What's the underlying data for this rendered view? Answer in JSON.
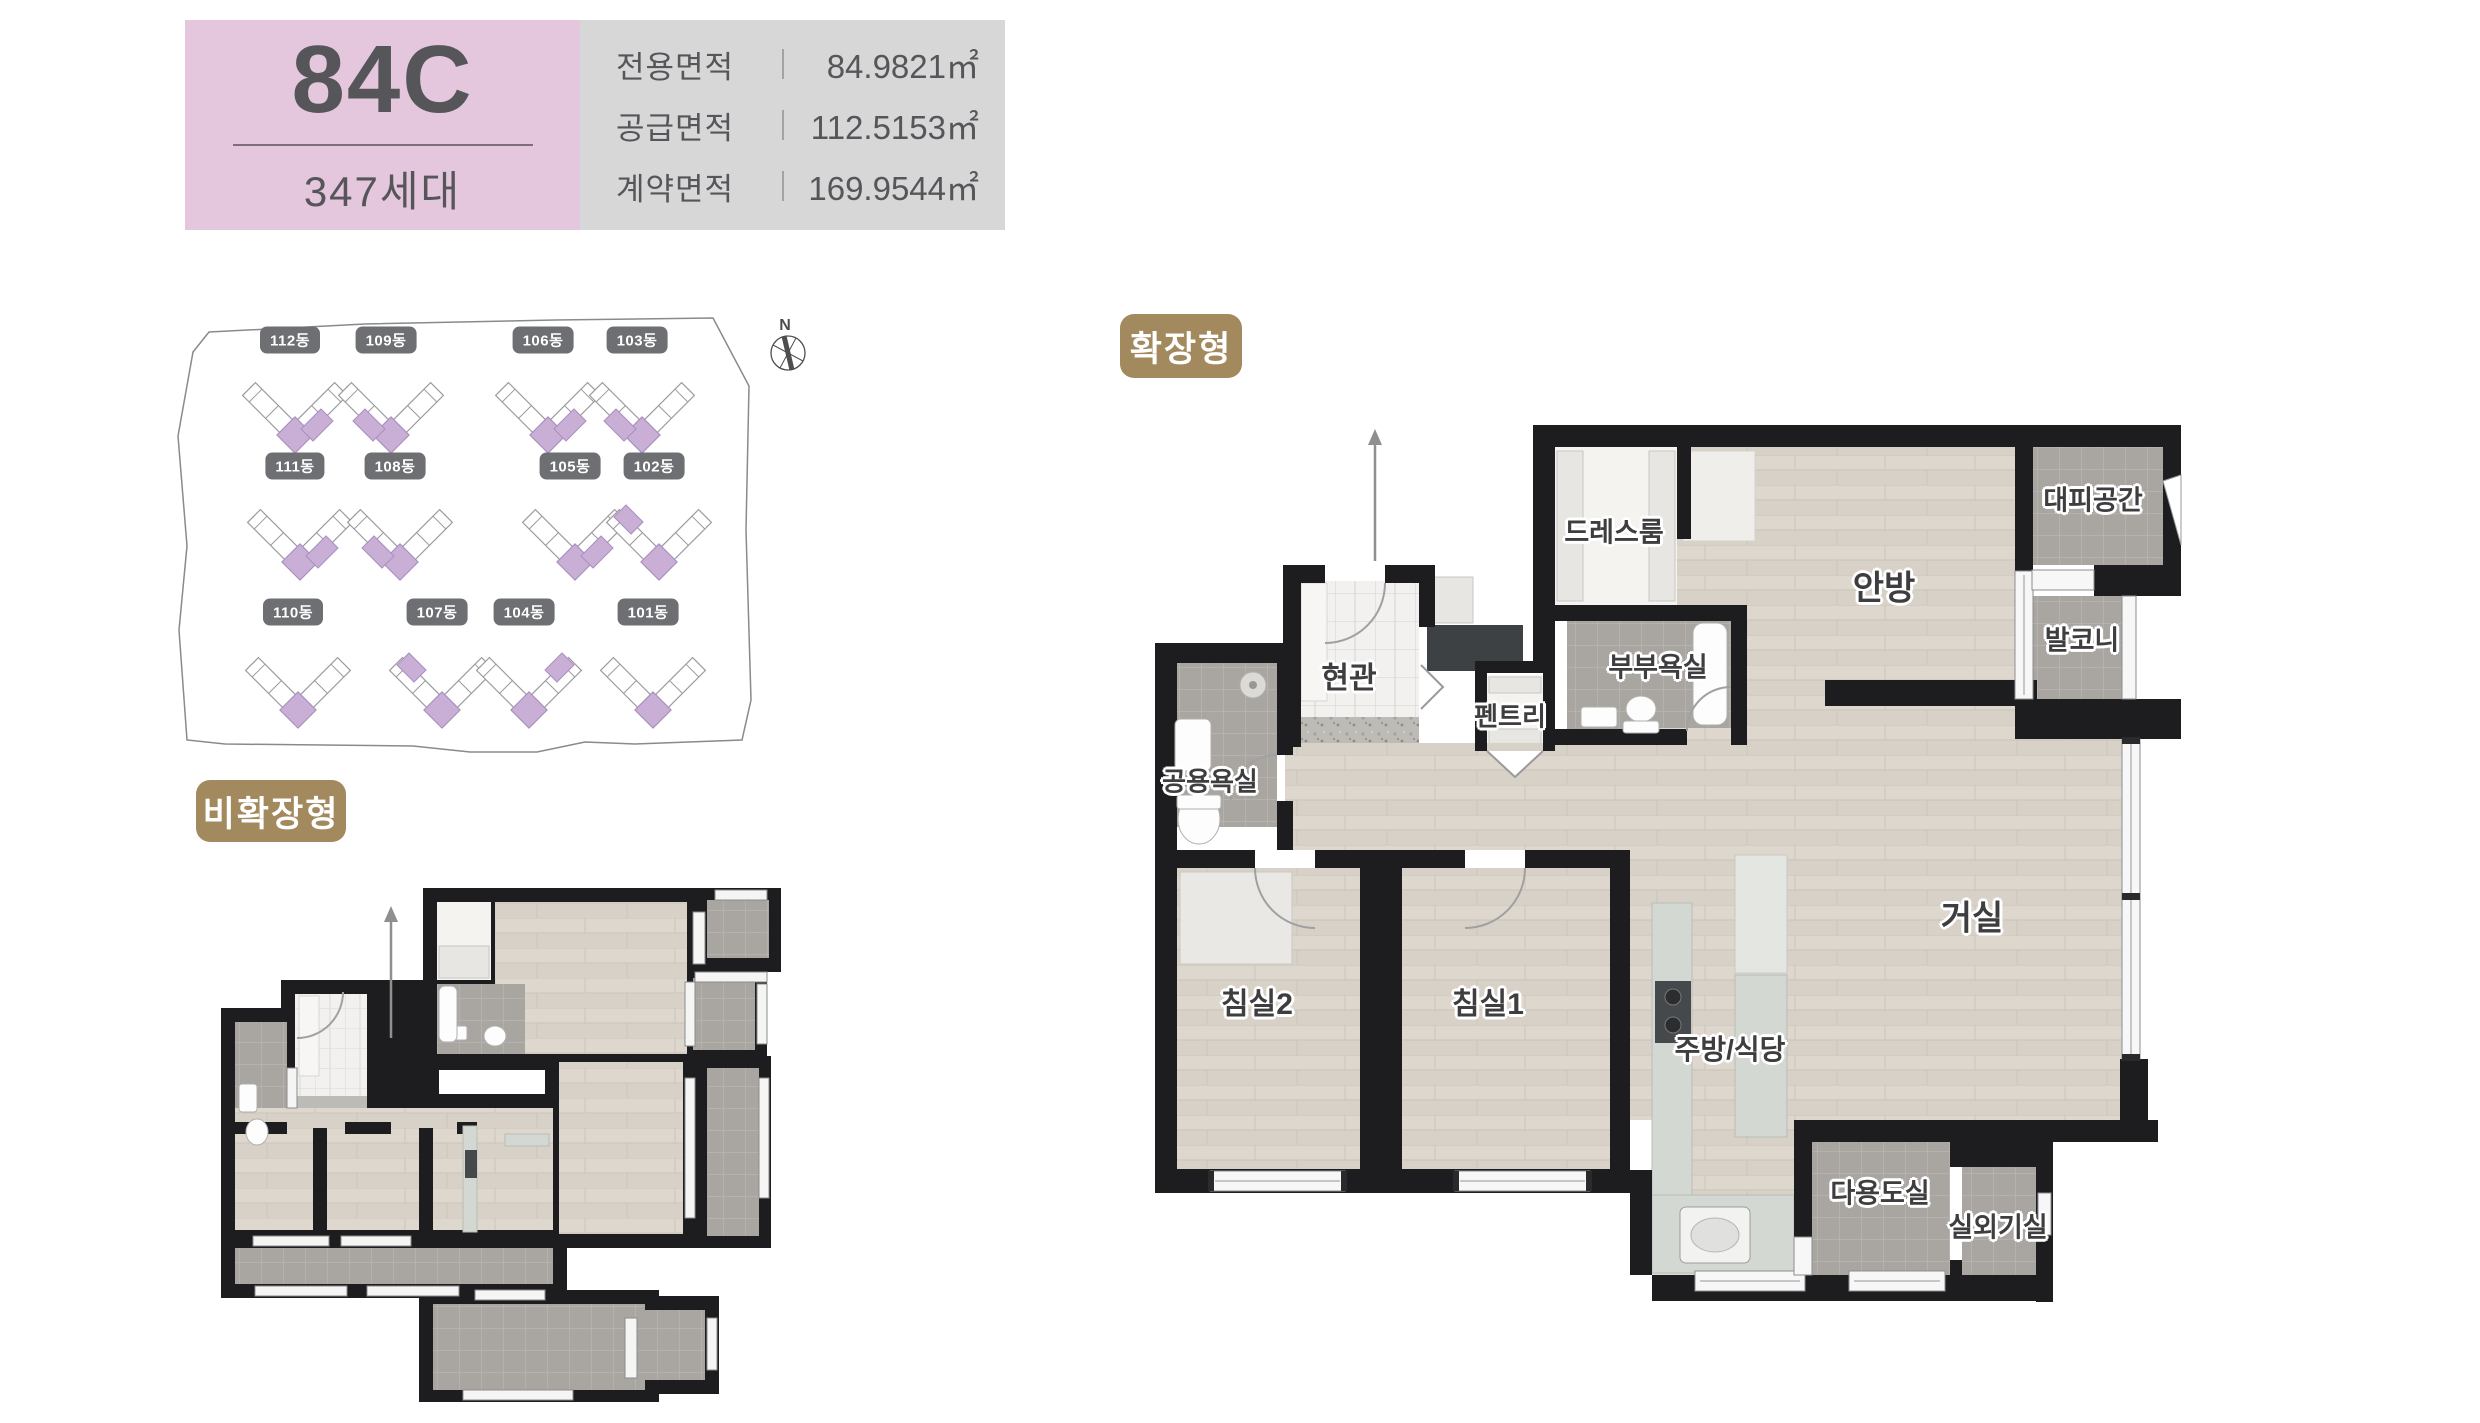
{
  "header": {
    "unit_code": "84C",
    "household_count": "347세대",
    "area_rows": [
      {
        "label": "전용면적",
        "value": "84.9821㎡"
      },
      {
        "label": "공급면적",
        "value": "112.5153㎡"
      },
      {
        "label": "계약면적",
        "value": "169.9544㎡"
      }
    ]
  },
  "site_plan": {
    "compass": "N",
    "buildings": [
      {
        "label": "112동"
      },
      {
        "label": "109동"
      },
      {
        "label": "106동"
      },
      {
        "label": "103동"
      },
      {
        "label": "111동"
      },
      {
        "label": "108동"
      },
      {
        "label": "105동"
      },
      {
        "label": "102동"
      },
      {
        "label": "110동"
      },
      {
        "label": "107동"
      },
      {
        "label": "104동"
      },
      {
        "label": "101동"
      }
    ]
  },
  "plan_non_extended": {
    "tag": "비확장형"
  },
  "plan_extended": {
    "tag": "확장형",
    "rooms": [
      {
        "name": "드레스룸"
      },
      {
        "name": "대피공간"
      },
      {
        "name": "안방"
      },
      {
        "name": "발코니"
      },
      {
        "name": "현관"
      },
      {
        "name": "부부욕실"
      },
      {
        "name": "펜트리"
      },
      {
        "name": "공용욕실"
      },
      {
        "name": "침실2"
      },
      {
        "name": "침실1"
      },
      {
        "name": "거실"
      },
      {
        "name": "주방/식당"
      },
      {
        "name": "다용도실"
      },
      {
        "name": "실외기실"
      }
    ]
  },
  "colors": {
    "accent_pink": "#e5c7dd",
    "accent_gray": "#d7d7d8",
    "tag_brown": "#a38a5e",
    "building_highlight": "#c9aed6",
    "badge_gray": "#6e6f72",
    "wall_black": "#1d1d1f"
  }
}
